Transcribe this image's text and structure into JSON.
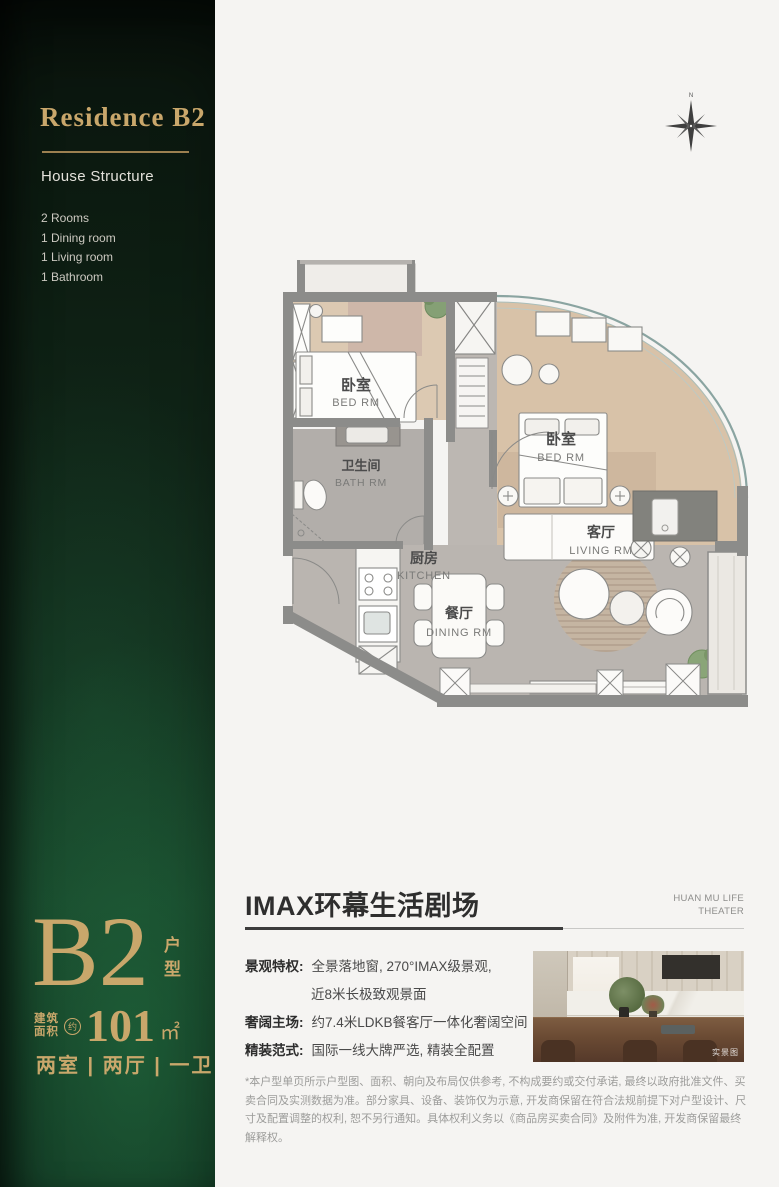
{
  "sidebar": {
    "title": "Residence B2",
    "subtitle": "House Structure",
    "rooms": [
      "2 Rooms",
      "1 Dining room",
      "1 Living room",
      "1 Bathroom"
    ],
    "unit_code": "B2",
    "unit_label": "户型",
    "area_prefix_line1": "建筑",
    "area_prefix_line2": "面积",
    "area_approx": "约",
    "area_value": "101",
    "area_unit": "㎡",
    "spec": "两室 | 两厅 | 一卫",
    "colors": {
      "gold": "#c9a76b",
      "green_dark": "#0d1d12",
      "green_bright": "#1c5a36"
    }
  },
  "compass": {
    "north_label": "N"
  },
  "floor_plan": {
    "bedroom1": {
      "cn": "卧室",
      "en": "BED RM"
    },
    "bathroom": {
      "cn": "卫生间",
      "en": "BATH RM"
    },
    "kitchen": {
      "cn": "厨房",
      "en": "KITCHEN"
    },
    "dining": {
      "cn": "餐厅",
      "en": "DINING RM"
    },
    "living": {
      "cn": "客厅",
      "en": "LIVING RM"
    },
    "bedroom2": {
      "cn": "卧室",
      "en": "BED RM"
    }
  },
  "details": {
    "headline": "IMAX环幕生活剧场",
    "brand_line1": "HUAN MU LIFE",
    "brand_line2": "THEATER",
    "features": [
      {
        "label": "景观特权:",
        "line1": "全景落地窗, 270°IMAX级景观,",
        "line2": "近8米长极致观景面"
      },
      {
        "label": "奢阔主场:",
        "line1": "约7.4米LDKB餐客厅一体化奢阔空间"
      },
      {
        "label": "精装范式:",
        "line1": "国际一线大牌严选, 精装全配置"
      }
    ],
    "photo_watermark": "实景图",
    "disclaimer": "*本户型单页所示户型图、面积、朝向及布局仅供参考, 不构成要约或交付承诺, 最终以政府批准文件、买卖合同及实测数据为准。部分家具、设备、装饰仅为示意, 开发商保留在符合法规前提下对户型设计、尺寸及配置调整的权利, 恕不另行通知。具体权利义务以《商品房买卖合同》及附件为准, 开发商保留最终解释权。"
  }
}
